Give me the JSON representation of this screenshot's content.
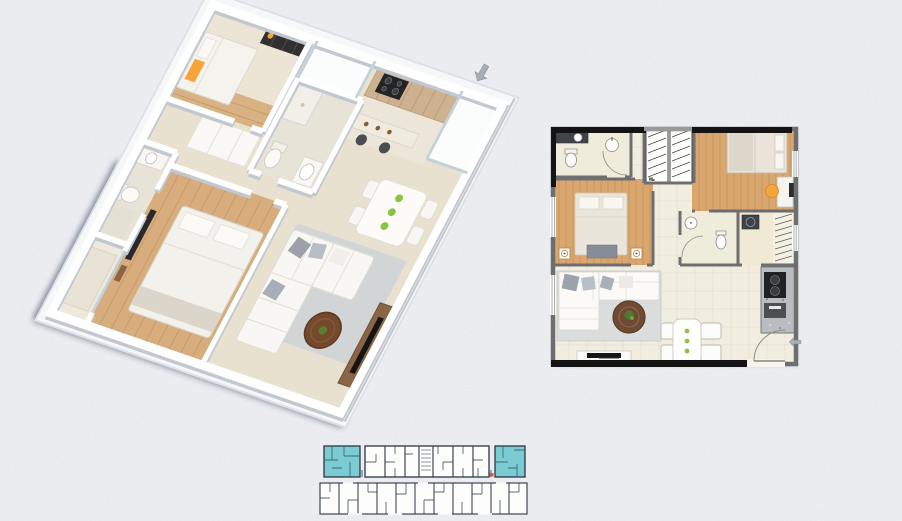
{
  "canvas": {
    "width": 902,
    "height": 521,
    "background": "#f2f3f6"
  },
  "palette": {
    "unit_highlight": "#7accd2",
    "arrow_gray": "#a6adb4",
    "accent_orange": "#f4a43a",
    "plate_green": "#8bc43f",
    "wood_floor": "#d9ab72",
    "wall_2d": "#6e6e6e",
    "keyplan_line": "#2b3642",
    "marker_red": "#e0553f",
    "coffee_table_brown": "#6f4b33"
  },
  "plan3d": {
    "type": "3d-isometric-floor-plan",
    "bedrooms": 2,
    "bathrooms": 2
  },
  "plan2d": {
    "type": "2d-top-view-floor-plan",
    "bedrooms": 2,
    "bathrooms": 2,
    "dining_seats": 4
  },
  "keyplan": {
    "type": "building-key-plan",
    "rows": 2,
    "highlighted_units": 2
  },
  "icons": [
    {
      "name": "arrow-down-left-icon"
    },
    {
      "name": "arrow-left-icon"
    }
  ]
}
